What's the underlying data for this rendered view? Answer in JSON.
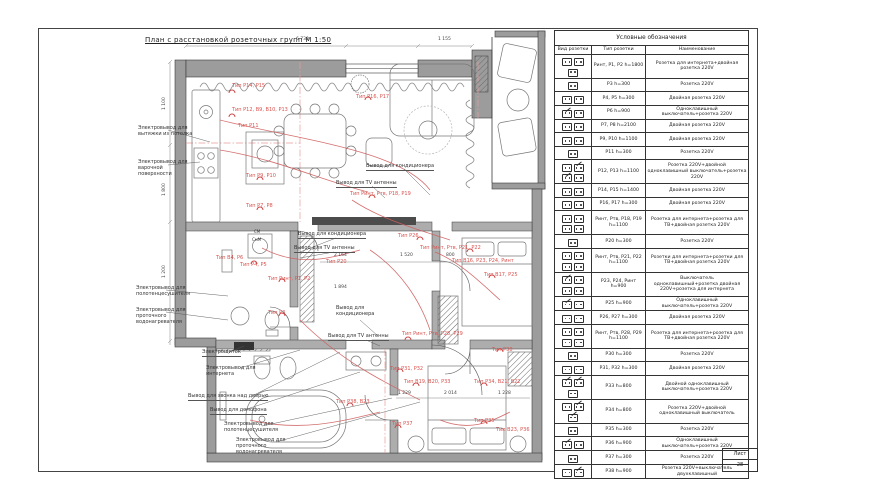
{
  "sheet": {
    "list_label": "Лист",
    "list_number": "28"
  },
  "plan": {
    "title": "План с расстановкой розеточных групп М 1:50",
    "annotations": [
      "Электровывод для вытяжки из потолка",
      "Электровывод для варочной поверхности",
      "Электровывод для полотенцесушителя",
      "Электровывод для проточного водонагревателя",
      "Электрощиток",
      "Электровывод для интернета",
      "Вывод для звонка над дверью",
      "Вывод для домофона",
      "Электровывод для полотенцесушителя",
      "Электровывод для проточного водонагревателя",
      "Вывод для кондиционера",
      "Вывод для TV антенны",
      "Вывод для кондиционера",
      "Вывод для TV антенны",
      "Вывод для кондиционера",
      "Вывод для TV антенны"
    ],
    "type_labels": [
      "Тип P14, P15",
      "Тип P12, B9, B10, P13",
      "Тип P11",
      "Тип P9, P10",
      "Тип P7, P8",
      "Тип P16, P17",
      "Тип Pинт, Pтв, P18, P19",
      "Тип P26",
      "Тип P20",
      "Тип Pинт, Pтв, P21, P22",
      "Тип B16, P23, P24, Pинт",
      "Тип B17, P25",
      "Тип Pинт, P1, P2",
      "Тип P3",
      "Тип B4, P6",
      "Тип P4, P5",
      "Тип Pинт, Pтв, P28, P29",
      "Тип P30",
      "Тип P31, P32",
      "Тип B19, B20, P33",
      "Тип P34, B21, B22",
      "Тип P38, B23",
      "Тип P37",
      "Тип P35",
      "Тип B23, P36"
    ],
    "dims": [
      "6 730",
      "1 155",
      "1 100",
      "1 800",
      "1 200",
      "2 164",
      "1 520",
      "800",
      "1 894",
      "1 229",
      "2 014",
      "1 228"
    ],
    "small_labels": [
      "СМ",
      "СмМ"
    ]
  },
  "legend": {
    "title": "Условные обозначения",
    "columns": [
      "Вид розетки",
      "Тип розетки",
      "Наименование"
    ],
    "rows": [
      {
        "icon": "sss",
        "type": "Pинт, P1, P2 h=1800",
        "name": "Розетка для интернета+двойная розетка 220V"
      },
      {
        "icon": "s",
        "type": "P3 h=300",
        "name": "Розетка 220V"
      },
      {
        "icon": "ss",
        "type": "P4, P5 h=300",
        "name": "Двойная розетка 220V"
      },
      {
        "icon": "ws",
        "type": "P6 h=900",
        "name": "Одноклавишный выключатель+розетка 220V"
      },
      {
        "icon": "ss",
        "type": "P7, P8 h=2100",
        "name": "Двойная розетка 220V"
      },
      {
        "icon": "ss",
        "type": "P9, P10 h=1100",
        "name": "Двойная розетка 220V"
      },
      {
        "icon": "s",
        "type": "P11 h=300",
        "name": "Розетка 220V"
      },
      {
        "icon": "swws",
        "type": "P12, P13 h=1100",
        "name": "Розетка 220V+двойной одноклавишный выключатель+розетка 220V"
      },
      {
        "icon": "ss",
        "type": "P14, P15 h=1400",
        "name": "Двойная розетка 220V"
      },
      {
        "icon": "ss",
        "type": "P16, P17 h=300",
        "name": "Двойная розетка 220V"
      },
      {
        "icon": "ssss",
        "type": "Pинт, Pтв, P18, P19 h=1100",
        "name": "Розетка для интернета+розетка для ТВ+двойная розетка 220V"
      },
      {
        "icon": "s",
        "type": "P20 h=300",
        "name": "Розетка 220V"
      },
      {
        "icon": "ssss",
        "type": "Pинт, Pтв, P21, P22 h=1100",
        "name": "Розетки для интернета+розетки для ТВ+двойная розетка 220V"
      },
      {
        "icon": "wsss",
        "type": "P23, P24, Pинт h=900",
        "name": "Выключатель одноклавишный+розетка двойная 220V+розетка для интернета"
      },
      {
        "icon": "ws",
        "type": "P25 h=900",
        "name": "Одноклавишный выключатель+розетка 220V"
      },
      {
        "icon": "ss",
        "type": "P26, P27 h=300",
        "name": "Двойная розетка 220V"
      },
      {
        "icon": "ssss",
        "type": "Pинт, Pтв, P28, P29 h=1100",
        "name": "Розетка для интернета+розетка для ТВ+двойная розетка 220V"
      },
      {
        "icon": "s",
        "type": "P30 h=300",
        "name": "Розетка 220V"
      },
      {
        "icon": "ss",
        "type": "P31, P32 h=300",
        "name": "Двойная розетка 220V"
      },
      {
        "icon": "wws",
        "type": "P33 h=800",
        "name": "Двойной одноклавишный выключатель+розетка 220V"
      },
      {
        "icon": "sww",
        "type": "P34 h=800",
        "name": "Розетка 220V+двойной одноклавишный выключатель"
      },
      {
        "icon": "s",
        "type": "P35 h=300",
        "name": "Розетка 220V"
      },
      {
        "icon": "ws",
        "type": "P36 h=900",
        "name": "Одноклавишный выключатель+розетка 220V"
      },
      {
        "icon": "s",
        "type": "P37 h=300",
        "name": "Розетка 220V"
      },
      {
        "icon": "sw",
        "type": "P38 h=900",
        "name": "Розетка 220V+выключатель двухклавишный"
      }
    ]
  }
}
